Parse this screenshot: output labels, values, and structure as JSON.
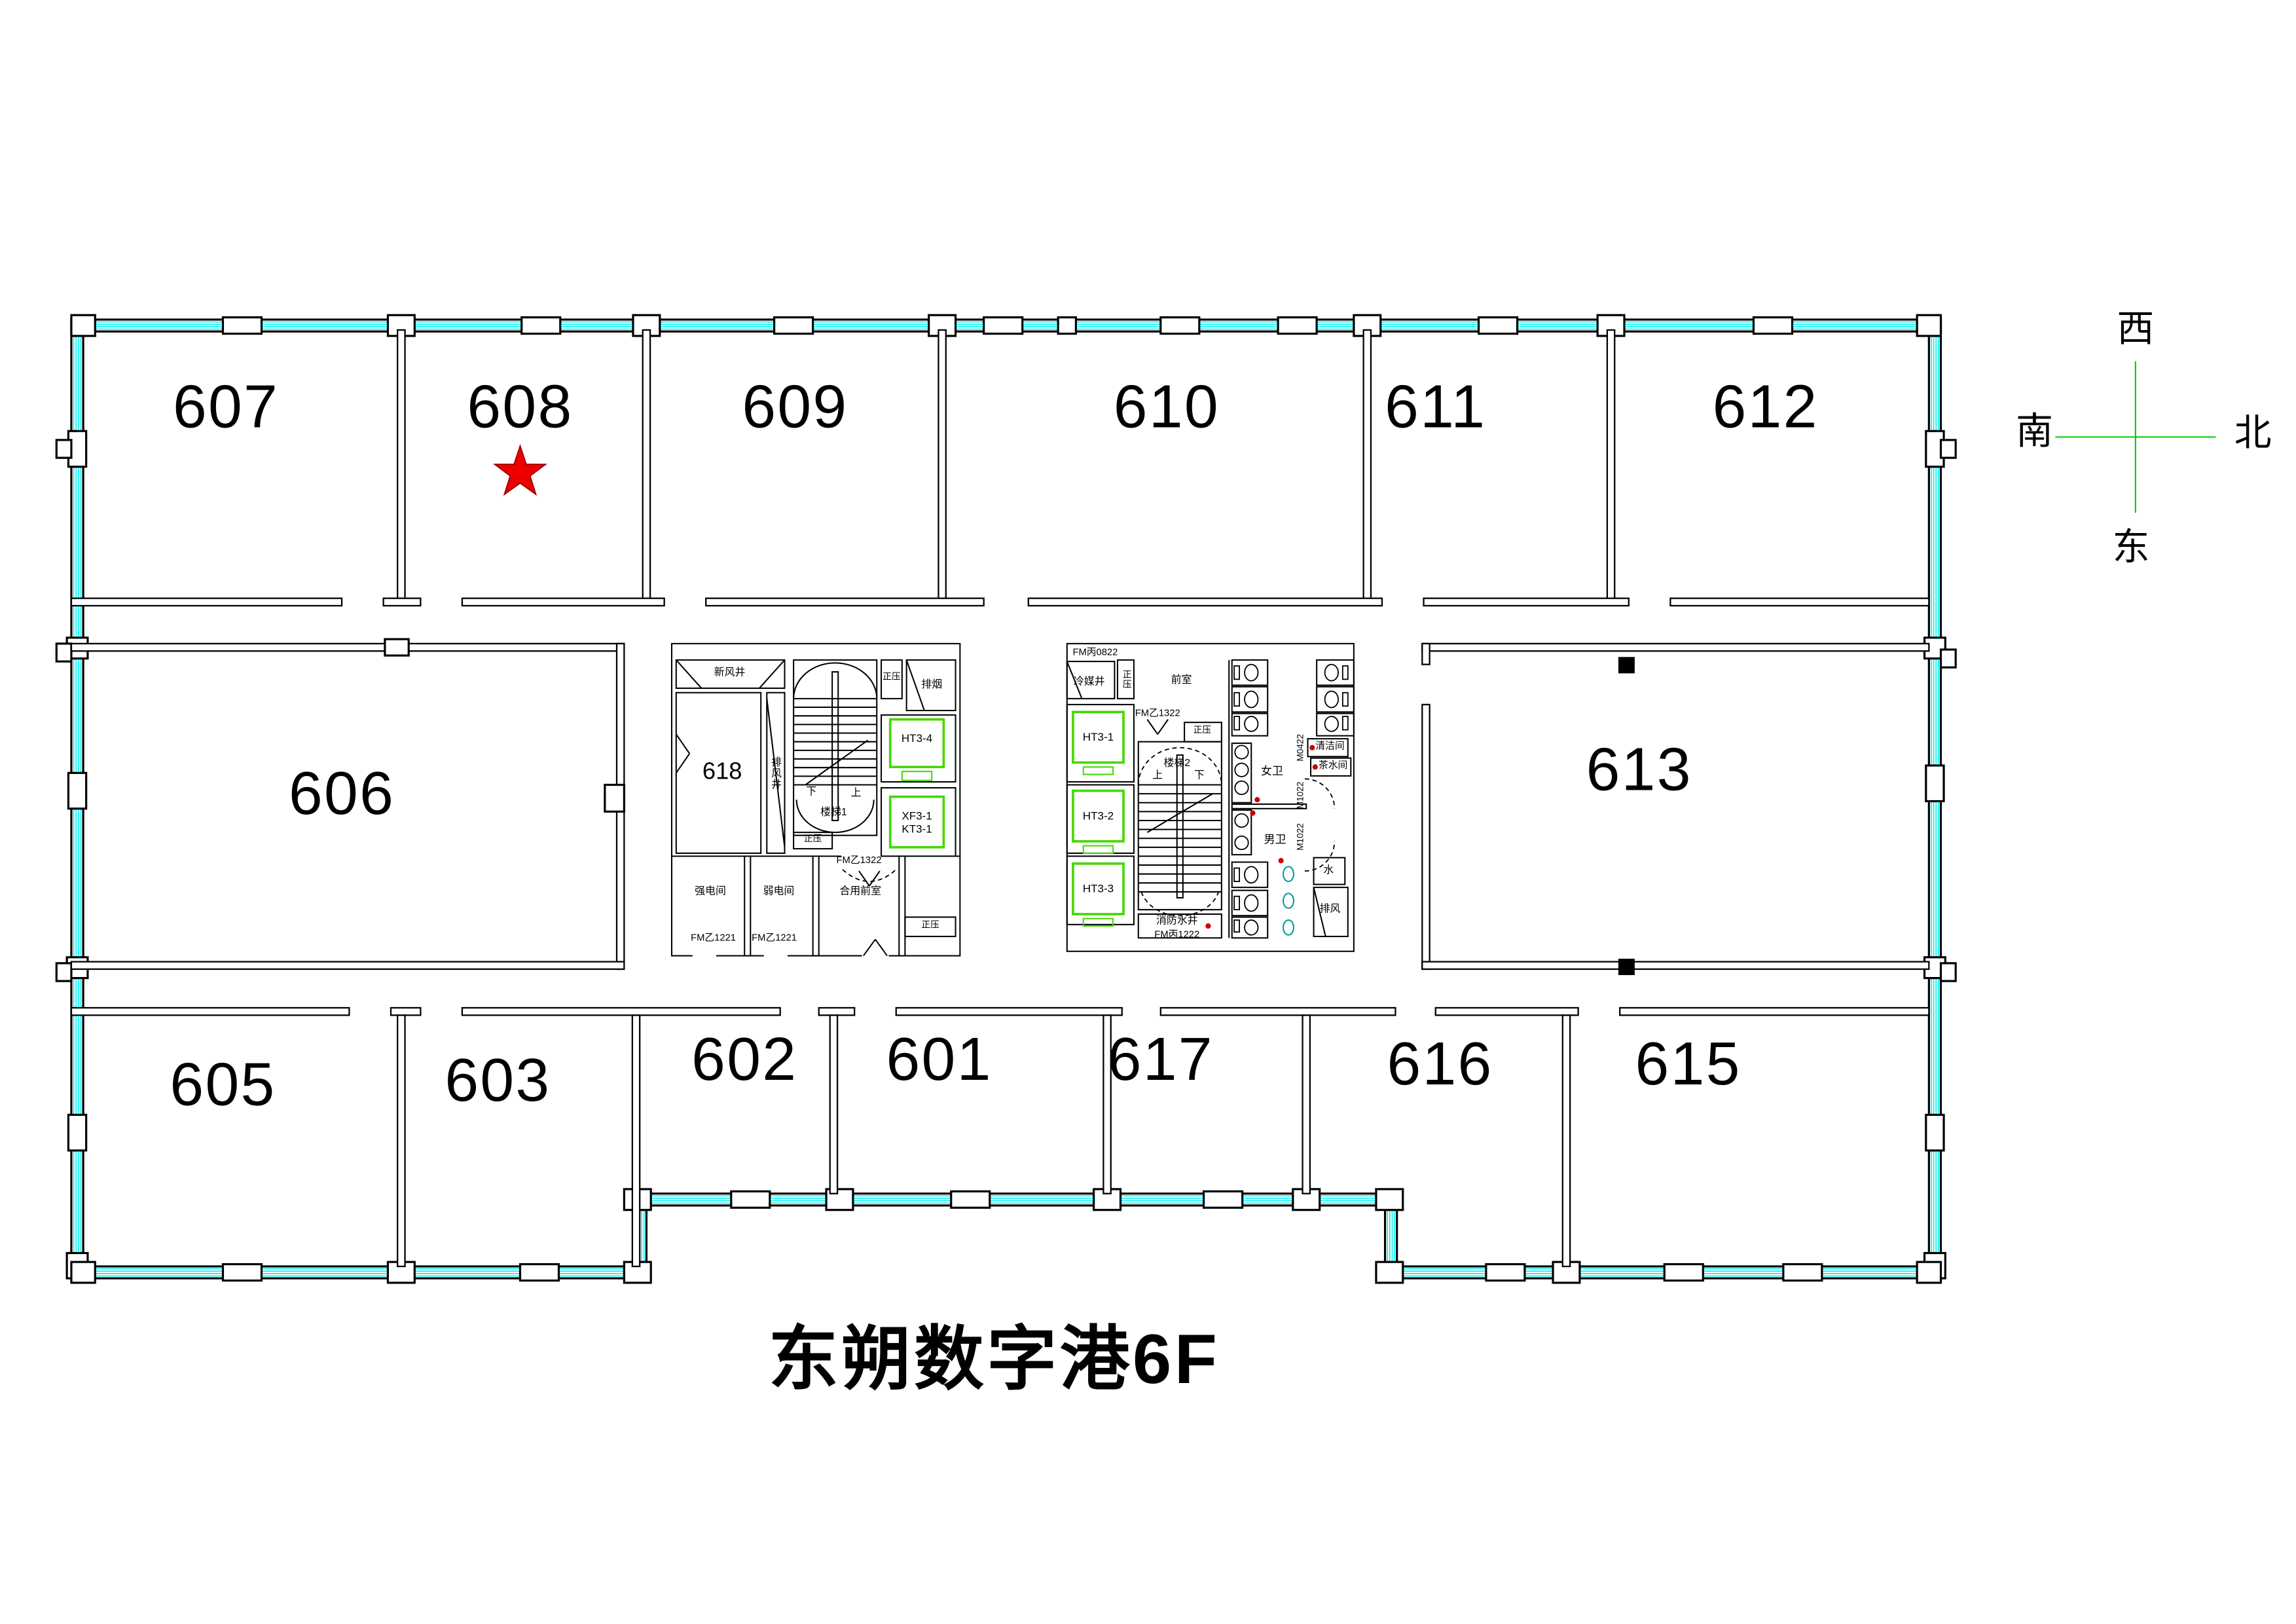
{
  "title": "东朔数字港6F",
  "compass": {
    "top": "西",
    "bottom": "东",
    "left": "南",
    "right": "北"
  },
  "colors": {
    "wall": "#000000",
    "window_band": "#00efef",
    "elevator_green": "#44d800",
    "compass_green": "#00c800",
    "star_red": "#ee0000",
    "star_outline": "#990000",
    "drain_red": "#cc0000",
    "fixture_teal": "#009999"
  },
  "marker": {
    "type": "star",
    "room": "608"
  },
  "rooms": [
    {
      "number": "607"
    },
    {
      "number": "608"
    },
    {
      "number": "609"
    },
    {
      "number": "610"
    },
    {
      "number": "611"
    },
    {
      "number": "612"
    },
    {
      "number": "606"
    },
    {
      "number": "613"
    },
    {
      "number": "618"
    },
    {
      "number": "605"
    },
    {
      "number": "603"
    },
    {
      "number": "602"
    },
    {
      "number": "601"
    },
    {
      "number": "617"
    },
    {
      "number": "616"
    },
    {
      "number": "615"
    }
  ],
  "core_left": {
    "fresh_air_shaft": "新风井",
    "exhaust_air_shaft": "排风井",
    "stair": "楼梯1",
    "up": "上",
    "down": "下",
    "positive_pressure": "正压",
    "smoke_exhaust": "排烟",
    "elevator_1": "HT3-4",
    "elevator_2a": "XF3-1",
    "elevator_2b": "KT3-1",
    "strong_electric_room": "强电间",
    "weak_electric_room": "弱电间",
    "shared_vestibule": "合用前室",
    "fire_door_1221": "FM乙1221",
    "fire_door_1322": "FM乙1322"
  },
  "core_right": {
    "fire_door_0822": "FM丙0822",
    "refrigerant_shaft": "冷媒井",
    "vestibule": "前室",
    "fire_door_1322": "FM乙1322",
    "positive_pressure": "正压",
    "stair": "楼梯2",
    "up": "上",
    "down": "下",
    "elevator_1": "HT3-1",
    "elevator_2": "HT3-2",
    "elevator_3": "HT3-3",
    "fire_water_shaft": "消防水井",
    "fire_door_1222": "FM丙1222",
    "womens_toilet": "女卫",
    "mens_toilet": "男卫",
    "cleaning_room": "清洁间",
    "pantry": "茶水间",
    "door_m0422": "M0422",
    "door_m1022": "M1022",
    "water_room": "水",
    "exhaust_room": "排风"
  }
}
